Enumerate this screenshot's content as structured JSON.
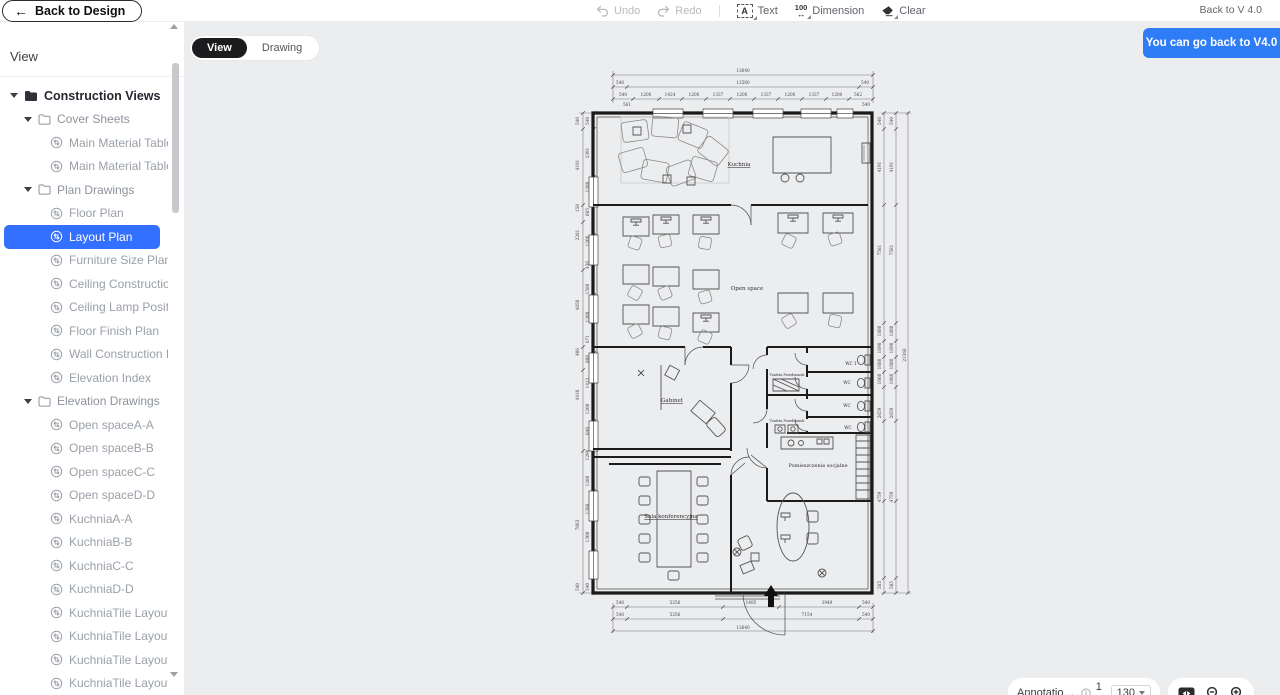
{
  "topbar": {
    "back_to_design": "Back to Design",
    "undo": "Undo",
    "redo": "Redo",
    "text_tool": "Text",
    "text_icon_letter": "A",
    "dimension_tool": "Dimension",
    "dimension_icon_number": "100",
    "dimension_icon_arrow": "↔",
    "clear_tool": "Clear",
    "back_to_v4": "Back to V 4.0"
  },
  "banner": {
    "text": "You can go back to V4.0",
    "color": "#2e7cf6"
  },
  "tabs": {
    "view": "View",
    "drawing": "Drawing",
    "active": "View"
  },
  "sidebar": {
    "title": "View",
    "tree": [
      {
        "label": "Construction Views",
        "level": 0,
        "type": "folder"
      },
      {
        "label": "Cover Sheets",
        "level": 1,
        "type": "folder"
      },
      {
        "label": "Main Material Table(1)",
        "level": 2,
        "type": "view"
      },
      {
        "label": "Main Material Table(2)",
        "level": 2,
        "type": "view"
      },
      {
        "label": "Plan Drawings",
        "level": 1,
        "type": "folder"
      },
      {
        "label": "Floor Plan",
        "level": 2,
        "type": "view"
      },
      {
        "label": "Layout Plan",
        "level": 2,
        "type": "view",
        "selected": true
      },
      {
        "label": "Furniture Size Plan",
        "level": 2,
        "type": "view"
      },
      {
        "label": "Ceiling Construction",
        "level": 2,
        "type": "view"
      },
      {
        "label": "Ceiling Lamp Position",
        "level": 2,
        "type": "view"
      },
      {
        "label": "Floor Finish Plan",
        "level": 2,
        "type": "view"
      },
      {
        "label": "Wall Construction Index",
        "level": 2,
        "type": "view"
      },
      {
        "label": "Elevation Index",
        "level": 2,
        "type": "view"
      },
      {
        "label": "Elevation Drawings",
        "level": 1,
        "type": "folder"
      },
      {
        "label": "Open spaceA-A",
        "level": 2,
        "type": "view"
      },
      {
        "label": "Open spaceB-B",
        "level": 2,
        "type": "view"
      },
      {
        "label": "Open spaceC-C",
        "level": 2,
        "type": "view"
      },
      {
        "label": "Open spaceD-D",
        "level": 2,
        "type": "view"
      },
      {
        "label": "KuchniaA-A",
        "level": 2,
        "type": "view"
      },
      {
        "label": "KuchniaB-B",
        "level": 2,
        "type": "view"
      },
      {
        "label": "KuchniaC-C",
        "level": 2,
        "type": "view"
      },
      {
        "label": "KuchniaD-D",
        "level": 2,
        "type": "view"
      },
      {
        "label": "KuchniaTile LayoutA-A",
        "level": 2,
        "type": "view"
      },
      {
        "label": "KuchniaTile LayoutB-B",
        "level": 2,
        "type": "view"
      },
      {
        "label": "KuchniaTile LayoutC-C",
        "level": 2,
        "type": "view"
      },
      {
        "label": "KuchniaTile LayoutD-D",
        "level": 2,
        "type": "view"
      }
    ]
  },
  "statusbar": {
    "annotation_style": "Annotation S...",
    "scale_prefix": "1 :",
    "scale_value": "130"
  },
  "colors": {
    "accent": "#3370ff",
    "banner": "#2e7cf6",
    "canvas": "#ecedef",
    "tab_active": "#1c1c1e"
  },
  "plan": {
    "rooms": [
      {
        "t": "Kuchnia",
        "x": 164,
        "y": 101,
        "s": 5.5,
        "u": true
      },
      {
        "t": "Open space",
        "x": 172,
        "y": 225,
        "s": 5.5
      },
      {
        "t": "Gabinet",
        "x": 97,
        "y": 337,
        "s": 5.5,
        "u": true
      },
      {
        "t": "Sala konferencyjna",
        "x": 96,
        "y": 453,
        "s": 5.5,
        "u": true
      },
      {
        "t": "Pomieszczenie socjalne",
        "x": 243,
        "y": 402,
        "s": 5
      },
      {
        "t": "Toaleta Przedsionek",
        "x": 212,
        "y": 311,
        "s": 3.4
      },
      {
        "t": "Toaleta Przedsionek",
        "x": 212,
        "y": 357,
        "s": 3.4
      },
      {
        "t": "WC 1",
        "x": 276,
        "y": 300,
        "s": 4.2
      },
      {
        "t": "WC",
        "x": 272,
        "y": 319,
        "s": 4.2
      },
      {
        "t": "WC",
        "x": 272,
        "y": 342,
        "s": 4.2
      },
      {
        "t": "WC",
        "x": 273,
        "y": 364,
        "s": 4.2
      }
    ],
    "dim_labels": [
      {
        "t": "13640",
        "x": 168,
        "y": 7
      },
      {
        "t": "540",
        "x": 45,
        "y": 19
      },
      {
        "t": "12560",
        "x": 168,
        "y": 19
      },
      {
        "t": "540",
        "x": 290,
        "y": 19
      },
      {
        "t": "540",
        "x": 48,
        "y": 31
      },
      {
        "t": "1200",
        "x": 71,
        "y": 31
      },
      {
        "t": "1424",
        "x": 95,
        "y": 31
      },
      {
        "t": "1200",
        "x": 119,
        "y": 31
      },
      {
        "t": "1337",
        "x": 143,
        "y": 31
      },
      {
        "t": "1200",
        "x": 167,
        "y": 31
      },
      {
        "t": "1337",
        "x": 191,
        "y": 31
      },
      {
        "t": "1200",
        "x": 215,
        "y": 31
      },
      {
        "t": "1337",
        "x": 239,
        "y": 31
      },
      {
        "t": "1200",
        "x": 262,
        "y": 31
      },
      {
        "t": "562",
        "x": 283,
        "y": 31
      },
      {
        "t": "561",
        "x": 52,
        "y": 41
      },
      {
        "t": "540",
        "x": 291,
        "y": 41
      },
      {
        "t": "540",
        "x": 45,
        "y": 539
      },
      {
        "t": "5256",
        "x": 100,
        "y": 539
      },
      {
        "t": "1495",
        "x": 176,
        "y": 539
      },
      {
        "t": "3949",
        "x": 252,
        "y": 539
      },
      {
        "t": "540",
        "x": 291,
        "y": 539
      },
      {
        "t": "540",
        "x": 45,
        "y": 551
      },
      {
        "t": "5256",
        "x": 100,
        "y": 551
      },
      {
        "t": "7154",
        "x": 232,
        "y": 551
      },
      {
        "t": "540",
        "x": 291,
        "y": 551
      },
      {
        "t": "13640",
        "x": 168,
        "y": 564
      },
      {
        "t": "540",
        "x": 4,
        "y": 56,
        "r": -90
      },
      {
        "t": "4191",
        "x": 4,
        "y": 100,
        "r": -90
      },
      {
        "t": "150",
        "x": 4,
        "y": 143,
        "r": -90
      },
      {
        "t": "2281",
        "x": 4,
        "y": 170,
        "r": -90
      },
      {
        "t": "4850",
        "x": 4,
        "y": 240,
        "r": -90
      },
      {
        "t": "406",
        "x": 4,
        "y": 287,
        "r": -90
      },
      {
        "t": "4410",
        "x": 4,
        "y": 330,
        "r": -90
      },
      {
        "t": "7083",
        "x": 4,
        "y": 460,
        "r": -90
      },
      {
        "t": "540",
        "x": 4,
        "y": 522,
        "r": -90
      },
      {
        "t": "540",
        "x": 14,
        "y": 56,
        "r": -90
      },
      {
        "t": "2391",
        "x": 14,
        "y": 88,
        "r": -90
      },
      {
        "t": "1200",
        "x": 14,
        "y": 122,
        "r": -90
      },
      {
        "t": "605",
        "x": 14,
        "y": 147,
        "r": -90
      },
      {
        "t": "1200",
        "x": 14,
        "y": 176,
        "r": -90
      },
      {
        "t": "436",
        "x": 14,
        "y": 200,
        "r": -90
      },
      {
        "t": "1580",
        "x": 14,
        "y": 224,
        "r": -90
      },
      {
        "t": "1200",
        "x": 14,
        "y": 252,
        "r": -90
      },
      {
        "t": "671",
        "x": 14,
        "y": 274,
        "r": -90
      },
      {
        "t": "800",
        "x": 14,
        "y": 294,
        "r": -90
      },
      {
        "t": "1412",
        "x": 14,
        "y": 318,
        "r": -90
      },
      {
        "t": "1200",
        "x": 14,
        "y": 344,
        "r": -90
      },
      {
        "t": "640",
        "x": 14,
        "y": 366,
        "r": -90
      },
      {
        "t": "1290",
        "x": 14,
        "y": 390,
        "r": -90
      },
      {
        "t": "1280",
        "x": 14,
        "y": 416,
        "r": -90
      },
      {
        "t": "1398",
        "x": 14,
        "y": 444,
        "r": -90
      },
      {
        "t": "1300",
        "x": 14,
        "y": 472,
        "r": -90
      },
      {
        "t": "540",
        "x": 14,
        "y": 522,
        "r": -90
      },
      {
        "t": "540",
        "x": 306,
        "y": 56,
        "r": -90
      },
      {
        "t": "4191",
        "x": 306,
        "y": 102,
        "r": -90
      },
      {
        "t": "7581",
        "x": 306,
        "y": 185,
        "r": -90
      },
      {
        "t": "1800",
        "x": 306,
        "y": 266,
        "r": -90
      },
      {
        "t": "1690",
        "x": 306,
        "y": 283,
        "r": -90
      },
      {
        "t": "1080",
        "x": 306,
        "y": 299,
        "r": -90
      },
      {
        "t": "1060",
        "x": 306,
        "y": 314,
        "r": -90
      },
      {
        "t": "2659",
        "x": 306,
        "y": 348,
        "r": -90
      },
      {
        "t": "4759",
        "x": 306,
        "y": 432,
        "r": -90
      },
      {
        "t": "585",
        "x": 306,
        "y": 520,
        "r": -90
      },
      {
        "t": "540",
        "x": 318,
        "y": 56,
        "r": -90
      },
      {
        "t": "4191",
        "x": 318,
        "y": 102,
        "r": -90
      },
      {
        "t": "7581",
        "x": 318,
        "y": 185,
        "r": -90
      },
      {
        "t": "1800",
        "x": 318,
        "y": 266,
        "r": -90
      },
      {
        "t": "1690",
        "x": 318,
        "y": 283,
        "r": -90
      },
      {
        "t": "1080",
        "x": 318,
        "y": 299,
        "r": -90
      },
      {
        "t": "1060",
        "x": 318,
        "y": 314,
        "r": -90
      },
      {
        "t": "2659",
        "x": 318,
        "y": 348,
        "r": -90
      },
      {
        "t": "4759",
        "x": 318,
        "y": 432,
        "r": -90
      },
      {
        "t": "585",
        "x": 318,
        "y": 520,
        "r": -90
      },
      {
        "t": "21368",
        "x": 331,
        "y": 290,
        "r": -90
      }
    ]
  }
}
